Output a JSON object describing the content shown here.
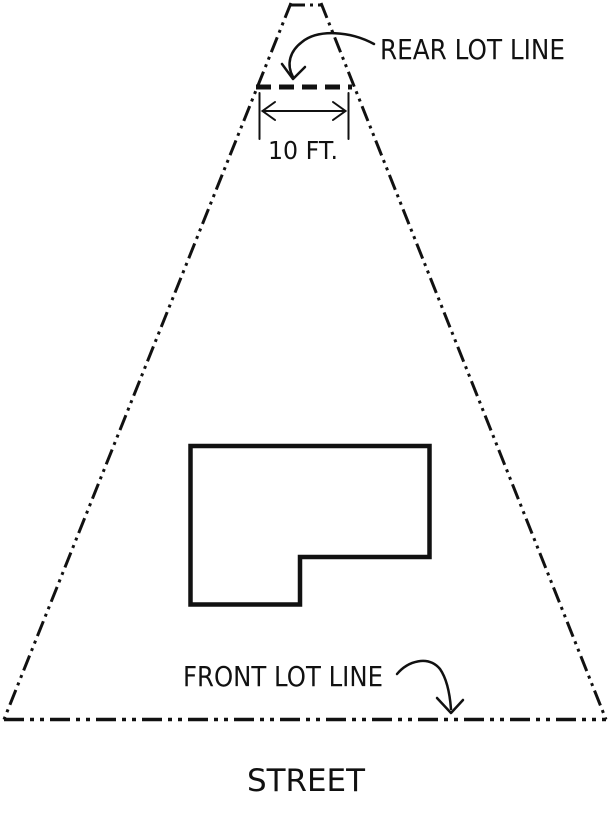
{
  "diagram": {
    "labels": {
      "rear_lot_line": "REAR LOT LINE",
      "dimension_width": "10 FT.",
      "front_lot_line": "FRONT LOT LINE",
      "street": "STREET"
    },
    "colors": {
      "line": "#111111",
      "background": "#ffffff"
    }
  }
}
